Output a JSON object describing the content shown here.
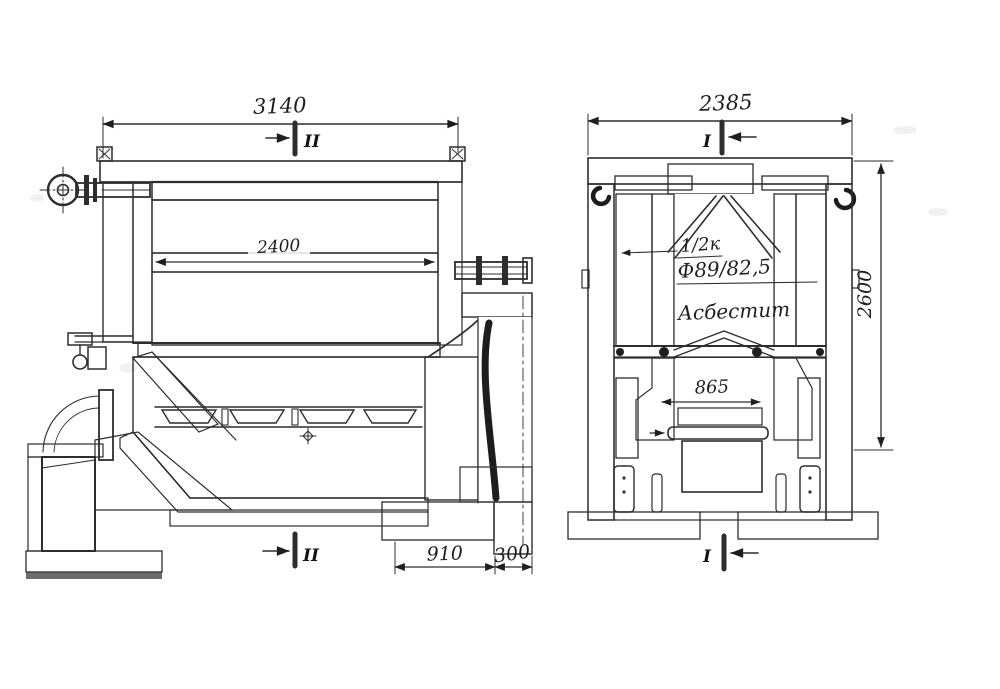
{
  "drawing": {
    "kind": "boiler-sectional-technical-drawing",
    "views": {
      "longitudinal_section": {
        "dim_overall_width": "3140",
        "dim_tube_bank_width": "2400",
        "dim_foundation_left": "910",
        "dim_foundation_right": "300",
        "section_mark_top": "II",
        "section_mark_bottom": "II"
      },
      "cross_section": {
        "dim_overall_width": "2385",
        "dim_overall_height": "2600",
        "dim_grate_width": "865",
        "label_pipe_note": "1/2к",
        "label_pipe_diameter": "Ф89/82,5",
        "label_insulation": "Асбестит",
        "section_mark_top": "I",
        "section_mark_bottom": "I"
      }
    },
    "colors": {
      "ink": "#2d2d2d",
      "paper": "#ffffff",
      "tube_fill": "#bdbdbd",
      "concrete_fill": "#dcdcdc"
    }
  }
}
